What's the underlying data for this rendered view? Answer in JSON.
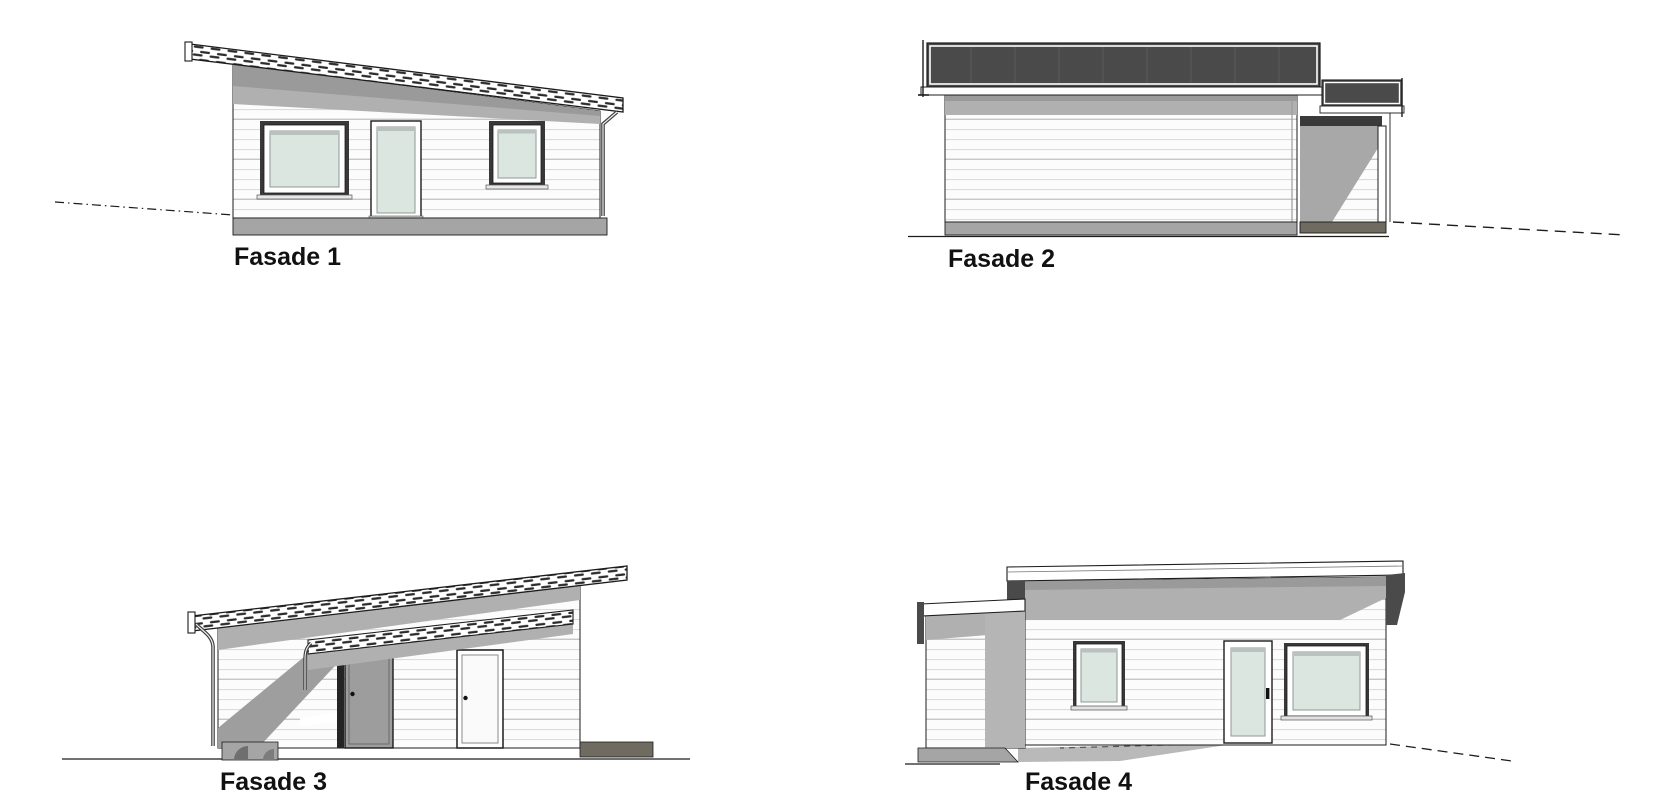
{
  "sheet": {
    "type": "architectural-elevations",
    "background": "#ffffff"
  },
  "palette": {
    "ink": "#1c1c1c",
    "roof-dark": "#4a4a4a",
    "roof-seam": "#5a5a5a",
    "shadow": "#b0b0b0",
    "shadow-deep": "#9a9a9a",
    "wall": "#fcfcfc",
    "siding": "#dcdcdc",
    "siding-dark": "#c6c6c6",
    "glass": "#dce6e0",
    "glass-edge": "#8f9a94",
    "frame-dark": "#383838",
    "foundation": "#a5a5a5",
    "pad": "#6f6b60",
    "door-gray": "#9d9d9d",
    "hatch": "#2a2a2a",
    "label": "#111111"
  },
  "drawings": [
    {
      "id": "fasade-1",
      "label": "Fasade 1",
      "description": "Front elevation: mono-pitch roof sloping down to the right, large window, glazed door, small window, downspout at right corner, terrain dash-dot line at left"
    },
    {
      "id": "fasade-2",
      "label": "Fasade 2",
      "description": "Side elevation: dark sloped roof surface seen edge-on, blank clad wall, attached carport with post at right, terrain dashes falling to the right"
    },
    {
      "id": "fasade-3",
      "label": "Fasade 3",
      "description": "Rear elevation: mono-pitch roof rising to the right, lower carport roof, recessed entry in shadow, gray entrance door and white side door"
    },
    {
      "id": "fasade-4",
      "label": "Fasade 4",
      "description": "Side elevation: fascia band, small window, glazed door, large window, attached carport at left, ground shadow in front"
    }
  ]
}
